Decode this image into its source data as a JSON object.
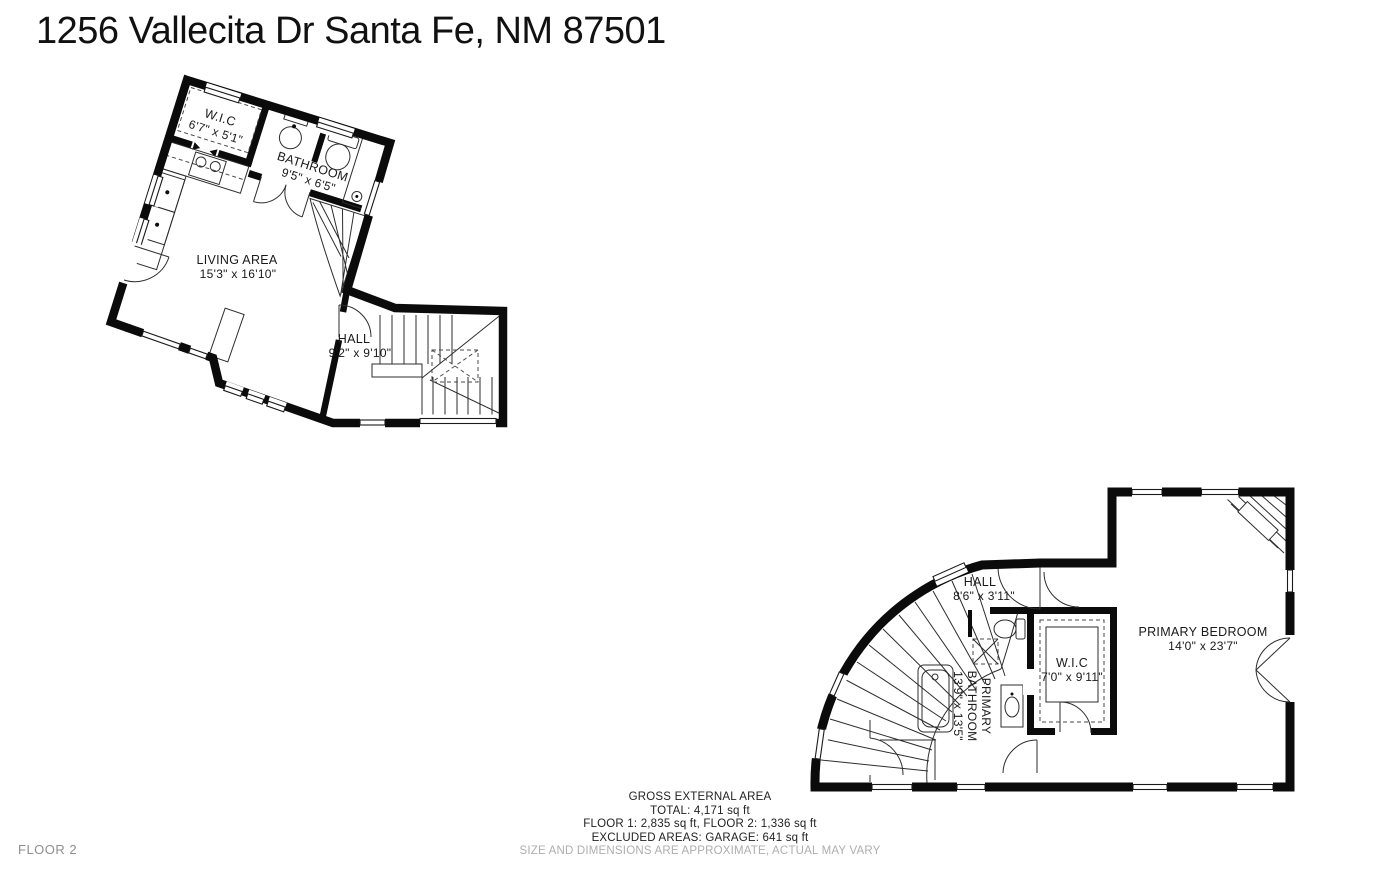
{
  "title": "1256 Vallecita Dr Santa Fe, NM 87501",
  "floor_label": "FLOOR 2",
  "colors": {
    "wall": "#0b0b0b",
    "text": "#1a1a1a",
    "muted": "#aeaeae"
  },
  "plan1": {
    "rooms": [
      {
        "name": "W.I.C",
        "dims": "6'7\" x 5'1\""
      },
      {
        "name": "BATHROOM",
        "dims": "9'5\" x 6'5\""
      },
      {
        "name": "LIVING AREA",
        "dims": "15'3\" x 16'10\""
      },
      {
        "name": "HALL",
        "dims": "9'2\" x 9'10\""
      }
    ]
  },
  "plan2": {
    "rooms": [
      {
        "name": "HALL",
        "dims": "8'6\" x 3'11\""
      },
      {
        "name": "PRIMARY BATHROOM",
        "name_lines": [
          "PRIMARY",
          "BATHROOM"
        ],
        "dims": "13'9\" x 13'5\""
      },
      {
        "name": "W.I.C",
        "dims": "7'0\" x 9'11\""
      },
      {
        "name": "PRIMARY BEDROOM",
        "dims": "14'0\" x 23'7\""
      }
    ]
  },
  "footer": {
    "heading": "GROSS EXTERNAL AREA",
    "total": "TOTAL: 4,171 sq ft",
    "floors": "FLOOR 1: 2,835 sq ft, FLOOR 2: 1,336 sq ft",
    "excluded": "EXCLUDED AREAS: GARAGE: 641 sq ft",
    "disclaimer": "SIZE AND DIMENSIONS ARE APPROXIMATE, ACTUAL MAY VARY"
  }
}
